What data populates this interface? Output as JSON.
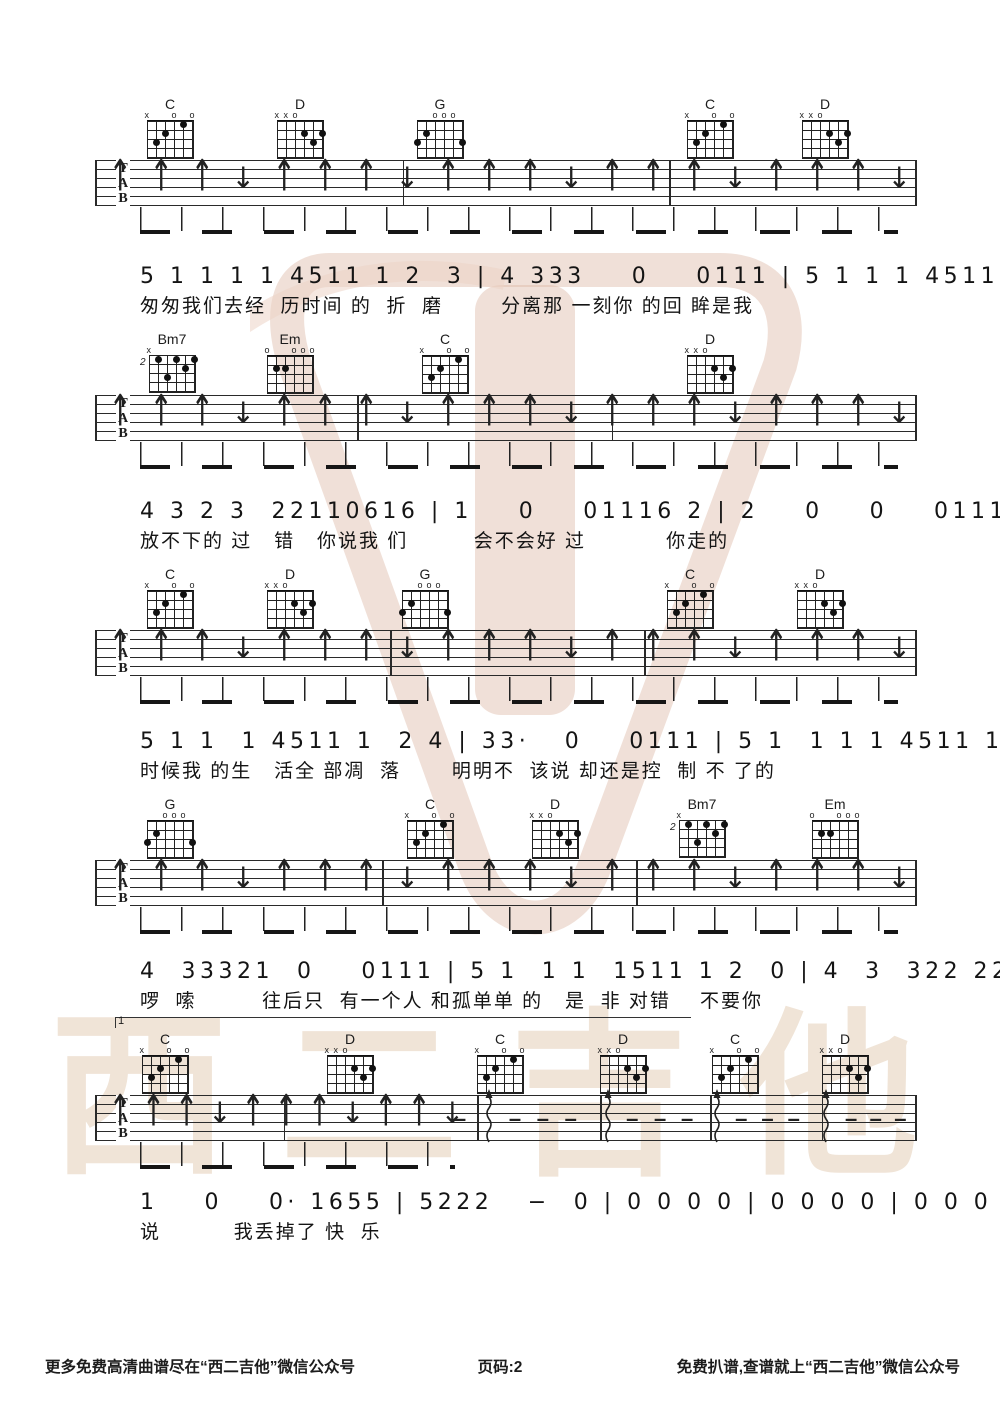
{
  "page": {
    "ink": "#1c1c1c",
    "watermark_pink": "#dcb4a3",
    "watermark_beige": "#f0e4d7",
    "watermark_text": "西二吉他",
    "glyphs": {
      "up_arrow": "↑",
      "down_arrow": "↓",
      "rest_dash": "–",
      "muted": "x",
      "open": "o"
    }
  },
  "footer": {
    "left": "更多免费高清曲谱尽在“西二吉他”微信公众号",
    "center": "页码:2",
    "right": "免费扒谱,查谱就上“西二吉他”微信公众号"
  },
  "tab_clef": [
    "T",
    "A",
    "B"
  ],
  "chord_shapes": {
    "C": {
      "markers": [
        "x",
        "",
        "",
        "o",
        "",
        "o"
      ],
      "dots": [
        [
          1,
          3
        ],
        [
          2,
          2
        ],
        [
          4,
          1
        ]
      ]
    },
    "D": {
      "markers": [
        "x",
        "x",
        "o",
        "",
        "",
        ""
      ],
      "dots": [
        [
          3,
          2
        ],
        [
          5,
          2
        ],
        [
          4,
          3
        ]
      ]
    },
    "G": {
      "markers": [
        "",
        "",
        "o",
        "o",
        "o",
        ""
      ],
      "dots": [
        [
          0,
          3
        ],
        [
          1,
          2
        ],
        [
          5,
          3
        ]
      ]
    },
    "Em": {
      "markers": [
        "o",
        "",
        "",
        "o",
        "o",
        "o"
      ],
      "dots": [
        [
          1,
          2
        ],
        [
          2,
          2
        ]
      ]
    },
    "Bm7": {
      "markers": [
        "x",
        "",
        "",
        "",
        "",
        ""
      ],
      "base": "2",
      "dots": [
        [
          1,
          1
        ],
        [
          3,
          1
        ],
        [
          5,
          1
        ],
        [
          4,
          2
        ],
        [
          2,
          3
        ]
      ]
    }
  },
  "systems": [
    {
      "staff_y": 160,
      "chords": [
        {
          "name": "C",
          "x": 170
        },
        {
          "name": "D",
          "x": 300
        },
        {
          "name": "G",
          "x": 440
        },
        {
          "name": "C",
          "x": 710
        },
        {
          "name": "D",
          "x": 825
        }
      ],
      "barlines": [
        0,
        0.375,
        0.7,
        1
      ],
      "arrows": "uuuduuuduuuduuuduuud",
      "arrow_span": [
        0.025,
        0.975
      ],
      "waves": [],
      "dashes": [],
      "beam": {
        "left": 140,
        "width": 758
      },
      "vocal": {
        "y": 264,
        "digits": "5 1 1 1 1 4511 1 2  3 | 4 333    0    0111 | 5 1 1 1 4511 1 2  0 |",
        "lyrics": "匆匆我们去经  历时间 的  折  磨        分离那 一刻你 的回 眸是我"
      }
    },
    {
      "staff_y": 395,
      "chords": [
        {
          "name": "Bm7",
          "x": 172
        },
        {
          "name": "Em",
          "x": 290
        },
        {
          "name": "C",
          "x": 445
        },
        {
          "name": "D",
          "x": 710
        }
      ],
      "barlines": [
        0,
        0.32,
        0.63,
        1
      ],
      "arrows": "uuuduuuduuuduuuduuud",
      "arrow_span": [
        0.025,
        0.975
      ],
      "waves": [],
      "dashes": [],
      "beam": {
        "left": 140,
        "width": 758
      },
      "vocal": {
        "y": 499,
        "digits": "4 3 2 3  22110616 | 1    0    01116 2 | 2    0    0    0111 |",
        "lyrics": "放不下的 过   错   你说我 们         会不会好 过           你走的"
      }
    },
    {
      "staff_y": 630,
      "chords": [
        {
          "name": "C",
          "x": 170
        },
        {
          "name": "D",
          "x": 290
        },
        {
          "name": "G",
          "x": 425
        },
        {
          "name": "C",
          "x": 690
        },
        {
          "name": "D",
          "x": 820
        }
      ],
      "barlines": [
        0,
        0.36,
        0.67,
        1
      ],
      "arrows": "uuuduuuduuuduuuduuud",
      "arrow_span": [
        0.025,
        0.975
      ],
      "waves": [],
      "dashes": [],
      "beam": {
        "left": 140,
        "width": 758
      },
      "vocal": {
        "y": 729,
        "digits": "5 1 1  1 4511 1  2 4 | 33·   0    0111 | 5 1  1 1 1 4511 1  2 3 |",
        "lyrics": "时候我 的生   活全 部凋  落       明明不  该说 却还是控  制 不 了的"
      }
    },
    {
      "staff_y": 860,
      "chords": [
        {
          "name": "G",
          "x": 170
        },
        {
          "name": "C",
          "x": 430
        },
        {
          "name": "D",
          "x": 555
        },
        {
          "name": "Bm7",
          "x": 702
        },
        {
          "name": "Em",
          "x": 835
        }
      ],
      "barlines": [
        0,
        0.35,
        0.66,
        1
      ],
      "arrows": "uuuduuuduuuduuuduuud",
      "arrow_span": [
        0.025,
        0.975
      ],
      "waves": [],
      "dashes": [],
      "beam": {
        "left": 140,
        "width": 758
      },
      "volta": "1",
      "vocal": {
        "y": 959,
        "digits": "4  33321  0    0111 | 5 1  1 1  1511 1 2  0 | 4  3  322 221·  0616 |",
        "lyrics": "啰  嗦         往后只  有一个人 和孤单单 的   是  非 对错    不要你"
      }
    },
    {
      "staff_y": 1095,
      "chords": [
        {
          "name": "C",
          "x": 165
        },
        {
          "name": "D",
          "x": 350
        },
        {
          "name": "C",
          "x": 500
        },
        {
          "name": "D",
          "x": 623
        },
        {
          "name": "C",
          "x": 735
        },
        {
          "name": "D",
          "x": 845
        }
      ],
      "barlines": [
        0,
        0.23,
        0.466,
        0.616,
        0.75,
        0.886,
        1
      ],
      "arrows": "uuuduuuduud",
      "arrow_span": [
        0.025,
        0.43
      ],
      "waves": [
        0.48,
        0.625,
        0.758,
        0.892
      ],
      "dashes": [
        0.445,
        0.512,
        0.546,
        0.58,
        0.655,
        0.689,
        0.722,
        0.788,
        0.82,
        0.852,
        0.922,
        0.952,
        0.982
      ],
      "beam": {
        "left": 140,
        "width": 315
      },
      "vocal": {
        "y": 1190,
        "digits": "1    0    0· 1655 | 5222   −  0 | 0 0 0 0 | 0 0 0 0 | 0 0 0 0 | 0 0 0 0 |",
        "lyrics": "说          我丢掉了 快  乐"
      }
    }
  ]
}
